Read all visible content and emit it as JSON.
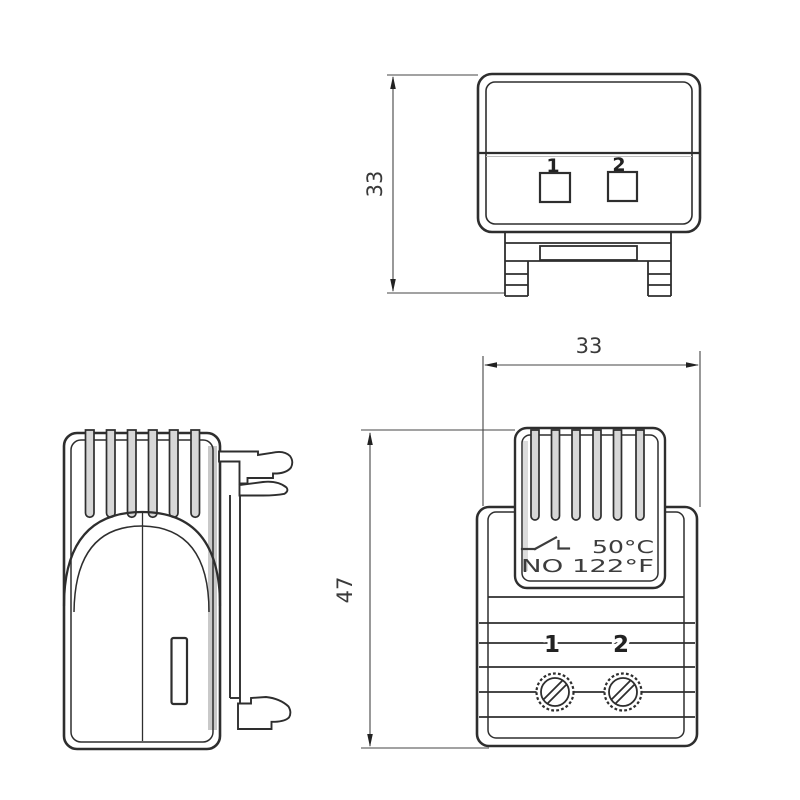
{
  "top_view": {
    "dimension_depth": "33",
    "terminal_1": "1",
    "terminal_2": "2"
  },
  "front_view": {
    "dimension_width": "33",
    "dimension_height": "47",
    "rating_celsius": "50°C",
    "rating_fahrenheit": "NO 122°F",
    "terminal_1": "1",
    "terminal_2": "2"
  },
  "icons": {
    "switch_symbol": "normally-open-contact-icon"
  },
  "colors": {
    "line": "#2e2e2e",
    "dim_line": "#454545",
    "shade": "#d7d7d7",
    "background": "#ffffff"
  }
}
